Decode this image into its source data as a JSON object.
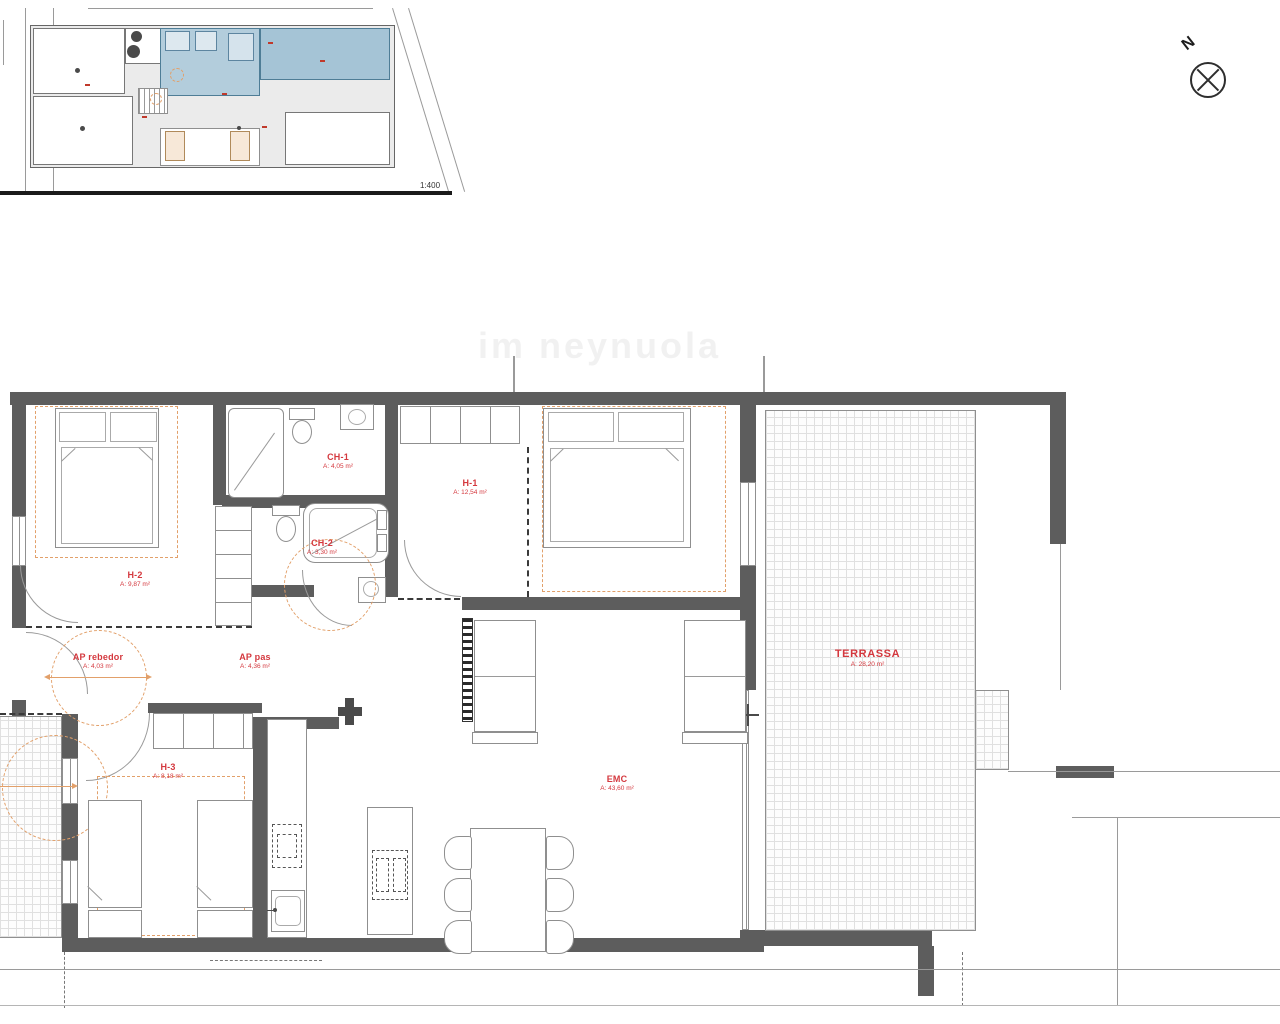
{
  "meta": {
    "watermark": "im neynuola"
  },
  "overview": {
    "scale_label": "1:400"
  },
  "compass": {
    "north_label": "N"
  },
  "colors": {
    "wall": "#5d5d5d",
    "accent_red": "#d4383e",
    "accent_orange": "#e2a06a",
    "highlight_blue": "#b3cddc"
  },
  "rooms": [
    {
      "id": "h2",
      "name": "H-2",
      "area": "A: 9,87 m²"
    },
    {
      "id": "ch1",
      "name": "CH-1",
      "area": "A: 4,05 m²"
    },
    {
      "id": "ch2",
      "name": "CH-2",
      "area": "A: 3,30 m²"
    },
    {
      "id": "h1",
      "name": "H-1",
      "area": "A: 12,54 m²"
    },
    {
      "id": "ap-rebedor",
      "name": "AP rebedor",
      "area": "A: 4,03 m²"
    },
    {
      "id": "ap-pas",
      "name": "AP pas",
      "area": "A: 4,36 m²"
    },
    {
      "id": "h3",
      "name": "H-3",
      "area": "A: 8,18 m²"
    },
    {
      "id": "emc",
      "name": "EMC",
      "area": "A: 43,60 m²"
    },
    {
      "id": "terrassa",
      "name": "TERRASSA",
      "area": "A: 28,20 m²"
    }
  ]
}
